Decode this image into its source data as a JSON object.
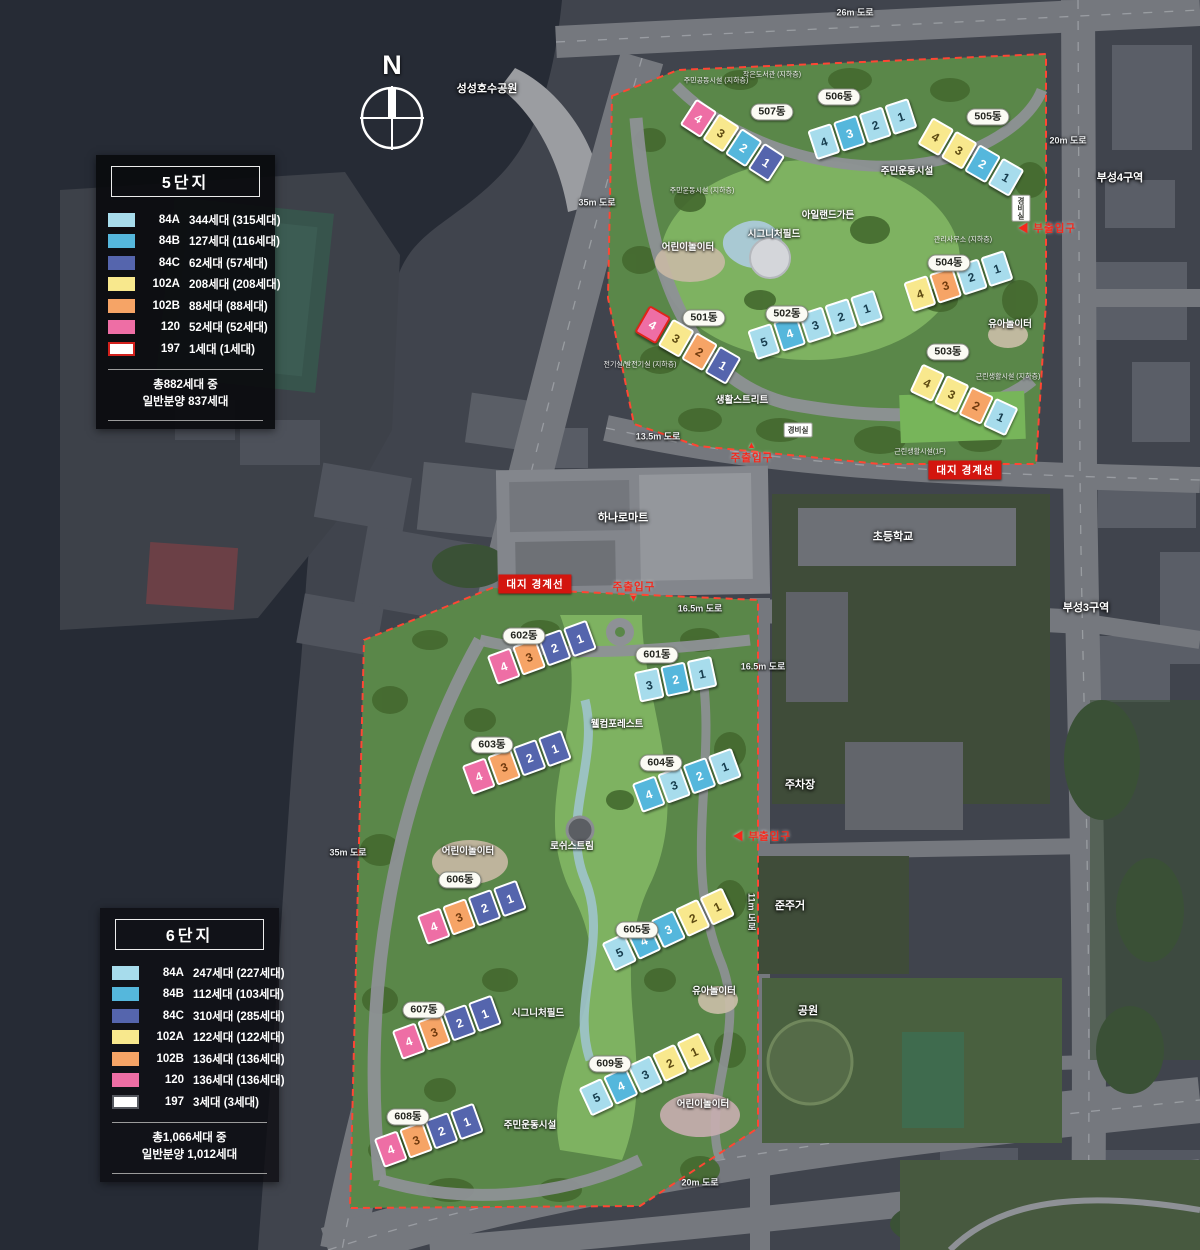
{
  "compass": {
    "label": "N"
  },
  "legends": [
    {
      "title": "5단지",
      "items": [
        {
          "type": "84A",
          "count": "344세대 (315세대)",
          "color": "#a7dcec"
        },
        {
          "type": "84B",
          "count": "127세대 (116세대)",
          "color": "#55b7dc"
        },
        {
          "type": "84C",
          "count": "62세대 (57세대)",
          "color": "#5565ad"
        },
        {
          "type": "102A",
          "count": "208세대 (208세대)",
          "color": "#f8e88d"
        },
        {
          "type": "102B",
          "count": "88세대 (88세대)",
          "color": "#f6a466"
        },
        {
          "type": "120",
          "count": "52세대 (52세대)",
          "color": "#ee6ea5"
        },
        {
          "type": "197",
          "count": "1세대 (1세대)",
          "color": "#ffffff",
          "swatch_border": "#d2201c"
        }
      ],
      "total_line1": "총882세대 중",
      "total_line2": "일반분양 837세대"
    },
    {
      "title": "6단지",
      "items": [
        {
          "type": "84A",
          "count": "247세대 (227세대)",
          "color": "#a7dcec"
        },
        {
          "type": "84B",
          "count": "112세대 (103세대)",
          "color": "#55b7dc"
        },
        {
          "type": "84C",
          "count": "310세대 (285세대)",
          "color": "#5565ad"
        },
        {
          "type": "102A",
          "count": "122세대 (122세대)",
          "color": "#f8e88d"
        },
        {
          "type": "102B",
          "count": "136세대 (136세대)",
          "color": "#f6a466"
        },
        {
          "type": "120",
          "count": "136세대 (136세대)",
          "color": "#ee6ea5"
        },
        {
          "type": "197",
          "count": "3세대 (3세대)",
          "color": "#ffffff",
          "swatch_border": "#55585f"
        }
      ],
      "total_line1": "총1,066세대 중",
      "total_line2": "일반분양 1,012세대"
    }
  ],
  "buildings": [
    {
      "name": "507동",
      "x": 688,
      "y": 96,
      "rot": 33,
      "lx": 772,
      "ly": 112,
      "units": [
        {
          "n": 4,
          "t": "120"
        },
        {
          "n": 3,
          "t": "102A"
        },
        {
          "n": 2,
          "t": "84B"
        },
        {
          "n": 1,
          "t": "84C"
        }
      ]
    },
    {
      "name": "506동",
      "x": 812,
      "y": 130,
      "rot": -18,
      "lx": 839,
      "ly": 97,
      "units": [
        {
          "n": 4,
          "t": "84A"
        },
        {
          "n": 3,
          "t": "84B"
        },
        {
          "n": 2,
          "t": "84A"
        },
        {
          "n": 1,
          "t": "84A"
        }
      ]
    },
    {
      "name": "505동",
      "x": 925,
      "y": 115,
      "rot": 30,
      "lx": 988,
      "ly": 117,
      "units": [
        {
          "n": 4,
          "t": "102A"
        },
        {
          "n": 3,
          "t": "102A"
        },
        {
          "n": 2,
          "t": "84B"
        },
        {
          "n": 1,
          "t": "84A"
        }
      ]
    },
    {
      "name": "501동",
      "x": 642,
      "y": 303,
      "rot": 30,
      "lx": 704,
      "ly": 318,
      "units": [
        {
          "n": 4,
          "t": "120",
          "outline": true
        },
        {
          "n": 3,
          "t": "102A"
        },
        {
          "n": 2,
          "t": "102B"
        },
        {
          "n": 1,
          "t": "84C"
        }
      ]
    },
    {
      "name": "502동",
      "x": 752,
      "y": 330,
      "rot": -18,
      "lx": 787,
      "ly": 314,
      "units": [
        {
          "n": 5,
          "t": "84A"
        },
        {
          "n": 4,
          "t": "84B"
        },
        {
          "n": 3,
          "t": "84A"
        },
        {
          "n": 2,
          "t": "84A"
        },
        {
          "n": 1,
          "t": "84A"
        }
      ]
    },
    {
      "name": "504동",
      "x": 908,
      "y": 282,
      "rot": -18,
      "lx": 949,
      "ly": 263,
      "units": [
        {
          "n": 4,
          "t": "102A"
        },
        {
          "n": 3,
          "t": "102B"
        },
        {
          "n": 2,
          "t": "84A"
        },
        {
          "n": 1,
          "t": "84A"
        }
      ]
    },
    {
      "name": "503동",
      "x": 916,
      "y": 362,
      "rot": 25,
      "lx": 948,
      "ly": 352,
      "units": [
        {
          "n": 4,
          "t": "102A"
        },
        {
          "n": 3,
          "t": "102A"
        },
        {
          "n": 2,
          "t": "102B"
        },
        {
          "n": 1,
          "t": "84A"
        }
      ]
    },
    {
      "name": "602동",
      "x": 492,
      "y": 655,
      "rot": -20,
      "lx": 524,
      "ly": 636,
      "units": [
        {
          "n": 4,
          "t": "120"
        },
        {
          "n": 3,
          "t": "102B"
        },
        {
          "n": 2,
          "t": "84C"
        },
        {
          "n": 1,
          "t": "84C"
        }
      ]
    },
    {
      "name": "601동",
      "x": 637,
      "y": 672,
      "rot": -12,
      "lx": 657,
      "ly": 655,
      "units": [
        {
          "n": 3,
          "t": "84A"
        },
        {
          "n": 2,
          "t": "84B"
        },
        {
          "n": 1,
          "t": "84A"
        }
      ]
    },
    {
      "name": "603동",
      "x": 467,
      "y": 765,
      "rot": -20,
      "lx": 492,
      "ly": 745,
      "units": [
        {
          "n": 4,
          "t": "120"
        },
        {
          "n": 3,
          "t": "102B"
        },
        {
          "n": 2,
          "t": "84C"
        },
        {
          "n": 1,
          "t": "84C"
        }
      ]
    },
    {
      "name": "604동",
      "x": 637,
      "y": 783,
      "rot": -20,
      "lx": 661,
      "ly": 763,
      "units": [
        {
          "n": 4,
          "t": "84B"
        },
        {
          "n": 3,
          "t": "84A"
        },
        {
          "n": 2,
          "t": "84B"
        },
        {
          "n": 1,
          "t": "84A"
        }
      ]
    },
    {
      "name": "606동",
      "x": 422,
      "y": 915,
      "rot": -20,
      "lx": 460,
      "ly": 880,
      "units": [
        {
          "n": 4,
          "t": "120"
        },
        {
          "n": 3,
          "t": "102B"
        },
        {
          "n": 2,
          "t": "84C"
        },
        {
          "n": 1,
          "t": "84C"
        }
      ]
    },
    {
      "name": "605동",
      "x": 608,
      "y": 942,
      "rot": -25,
      "lx": 637,
      "ly": 930,
      "units": [
        {
          "n": 5,
          "t": "84A"
        },
        {
          "n": 4,
          "t": "84B"
        },
        {
          "n": 3,
          "t": "84B"
        },
        {
          "n": 2,
          "t": "102A"
        },
        {
          "n": 1,
          "t": "102A"
        }
      ]
    },
    {
      "name": "607동",
      "x": 397,
      "y": 1030,
      "rot": -20,
      "lx": 424,
      "ly": 1010,
      "units": [
        {
          "n": 4,
          "t": "120"
        },
        {
          "n": 3,
          "t": "102B"
        },
        {
          "n": 2,
          "t": "84C"
        },
        {
          "n": 1,
          "t": "84C"
        }
      ]
    },
    {
      "name": "609동",
      "x": 585,
      "y": 1087,
      "rot": -25,
      "lx": 610,
      "ly": 1064,
      "units": [
        {
          "n": 5,
          "t": "84A"
        },
        {
          "n": 4,
          "t": "84B"
        },
        {
          "n": 3,
          "t": "84A"
        },
        {
          "n": 2,
          "t": "102A"
        },
        {
          "n": 1,
          "t": "102A"
        }
      ]
    },
    {
      "name": "608동",
      "x": 379,
      "y": 1138,
      "rot": -20,
      "lx": 408,
      "ly": 1117,
      "units": [
        {
          "n": 4,
          "t": "120"
        },
        {
          "n": 3,
          "t": "102B"
        },
        {
          "n": 2,
          "t": "84C"
        },
        {
          "n": 1,
          "t": "84C"
        }
      ]
    }
  ],
  "labels": {
    "roads": [
      {
        "text": "26m 도로",
        "x": 855,
        "y": 12
      },
      {
        "text": "20m 도로",
        "x": 1068,
        "y": 140
      },
      {
        "text": "35m 도로",
        "x": 597,
        "y": 202
      },
      {
        "text": "13.5m 도로",
        "x": 658,
        "y": 436
      },
      {
        "text": "16.5m 도로",
        "x": 700,
        "y": 608
      },
      {
        "text": "16.5m 도로",
        "x": 763,
        "y": 666
      },
      {
        "text": "35m 도로",
        "x": 348,
        "y": 852
      },
      {
        "text": "11m 도로",
        "x": 752,
        "y": 912,
        "vertical": true
      },
      {
        "text": "20m 도로",
        "x": 700,
        "y": 1182
      }
    ],
    "areas": [
      {
        "text": "성성호수공원",
        "x": 487,
        "y": 88
      },
      {
        "text": "부성4구역",
        "x": 1120,
        "y": 177
      },
      {
        "text": "부성3구역",
        "x": 1086,
        "y": 607
      },
      {
        "text": "하나로마트",
        "x": 623,
        "y": 517
      },
      {
        "text": "초등학교",
        "x": 893,
        "y": 536
      },
      {
        "text": "주차장",
        "x": 800,
        "y": 784
      },
      {
        "text": "준주거",
        "x": 790,
        "y": 905
      },
      {
        "text": "공원",
        "x": 808,
        "y": 1010
      }
    ],
    "facilities": [
      {
        "text": "주민운동시설",
        "x": 907,
        "y": 170
      },
      {
        "text": "아일랜드가든",
        "x": 828,
        "y": 214
      },
      {
        "text": "시그니처필드",
        "x": 774,
        "y": 233
      },
      {
        "text": "어린이놀이터",
        "x": 688,
        "y": 246
      },
      {
        "text": "유아놀이터",
        "x": 1010,
        "y": 323
      },
      {
        "text": "생활스트리트",
        "x": 742,
        "y": 399
      },
      {
        "text": "웰컴포레스트",
        "x": 617,
        "y": 723
      },
      {
        "text": "로쉬스트림",
        "x": 572,
        "y": 845
      },
      {
        "text": "어린이놀이터",
        "x": 468,
        "y": 850
      },
      {
        "text": "시그니처필드",
        "x": 538,
        "y": 1012
      },
      {
        "text": "유아놀이터",
        "x": 714,
        "y": 990
      },
      {
        "text": "어린이놀이터",
        "x": 703,
        "y": 1103
      },
      {
        "text": "주민운동시설",
        "x": 530,
        "y": 1124
      }
    ],
    "small_facilities": [
      {
        "text": "주민공동시설 (지하층)",
        "x": 716,
        "y": 82
      },
      {
        "text": "작은도서관 (지하층)",
        "x": 772,
        "y": 76
      },
      {
        "text": "주민운동시설 (지하층)",
        "x": 702,
        "y": 192
      },
      {
        "text": "관리사무소 (지하층)",
        "x": 963,
        "y": 241
      },
      {
        "text": "근린생활시설 (지하층)",
        "x": 1008,
        "y": 378
      },
      {
        "text": "근린생활시설(1F)",
        "x": 920,
        "y": 453
      },
      {
        "text": "전기실/발전기실 (지하층)",
        "x": 640,
        "y": 366
      }
    ],
    "guard_posts": [
      {
        "text": "경비실",
        "x": 798,
        "y": 430
      },
      {
        "text": "경비실",
        "x": 1021,
        "y": 208,
        "vertical": true
      }
    ],
    "entrances": [
      {
        "text": "주출입구",
        "x": 752,
        "y": 453,
        "marker": "▲",
        "marker_pos": "above"
      },
      {
        "text": "주출입구",
        "x": 634,
        "y": 591,
        "marker": "▼",
        "marker_pos": "below"
      },
      {
        "text": "◀ 부출입구",
        "x": 1047,
        "y": 228
      },
      {
        "text": "◀ 부출입구",
        "x": 762,
        "y": 836
      }
    ],
    "boundary_badges": [
      {
        "text": "대지 경계선",
        "x": 965,
        "y": 470
      },
      {
        "text": "대지 경계선",
        "x": 535,
        "y": 584
      }
    ]
  }
}
